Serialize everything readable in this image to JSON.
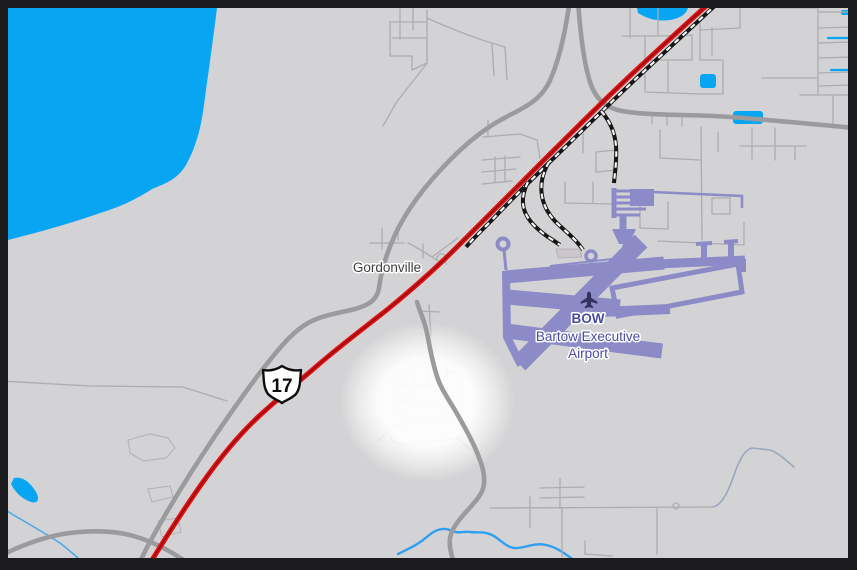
{
  "map": {
    "town_label": "Gordonville",
    "airport": {
      "code": "BOW",
      "name_line1": "Bartow Executive",
      "name_line2": "Airport"
    },
    "highway_shield": "17",
    "colors": {
      "background": "#d3d3d5",
      "frame": "#1b1b1d",
      "water": "#08a5f3",
      "stream": "#4aa8e8",
      "river": "#2f9ff2",
      "hill_stream": "#9aa6bb",
      "highway": "#e01113",
      "highway_center": "#8e0d10",
      "road_major": "#9b9a9c",
      "road_minor": "#adacae",
      "road_faint": "#b6b1b5",
      "railroad": "#161616",
      "railroad_dash": "#fafafa",
      "airport": "#8d8bc7",
      "airport_label": "#4c4ba0",
      "town_label": "#3e3e40",
      "building": "#cdc5cb",
      "highlight": "#ffffff"
    }
  }
}
